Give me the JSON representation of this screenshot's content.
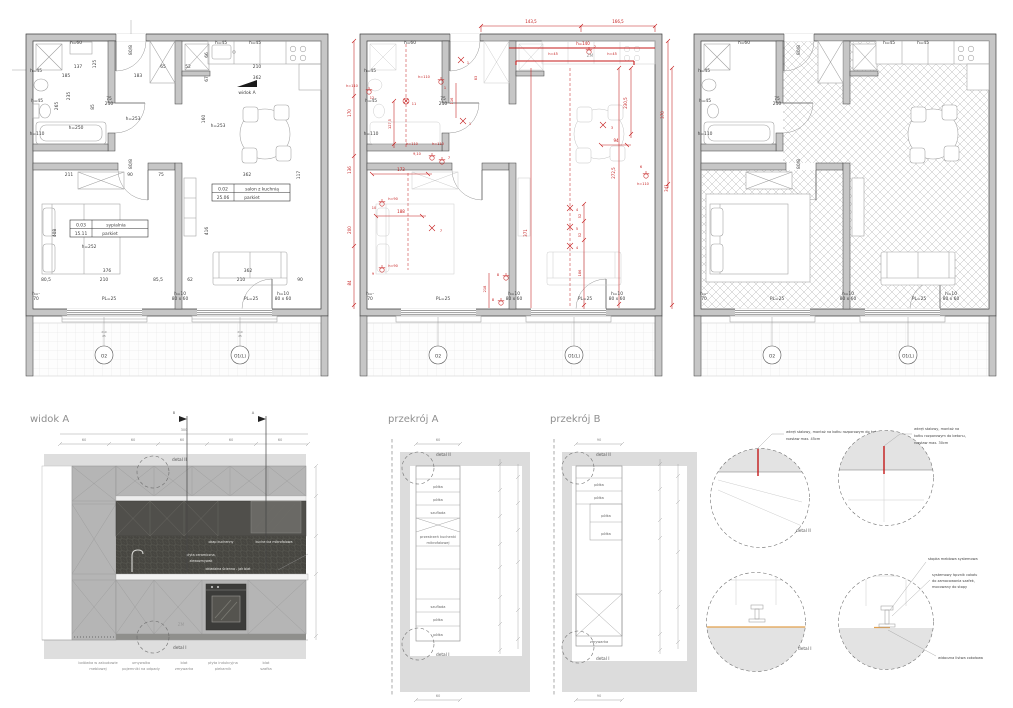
{
  "colors": {
    "red": "#c41a1a",
    "orange": "#e2a14e",
    "wall_gray": "#c6c6c6",
    "dark_tile": "#474641"
  },
  "plan1": {
    "labels": [
      "h=60",
      "137",
      "185",
      "125",
      "80/8",
      "183",
      "65",
      "52",
      "66",
      "h=45",
      "h=45",
      "210",
      "67",
      "362",
      "widok A",
      "h=45",
      "235",
      "265",
      "h=45",
      "75",
      "210",
      "85",
      "h=253",
      "160",
      "h=253",
      "h=250",
      "h=110",
      "362",
      "117",
      "211",
      "90",
      "75",
      "80/8",
      "408",
      "h=252",
      "416",
      "376",
      "80,5",
      "210",
      "85,5",
      "62",
      "210",
      "90",
      "362",
      "h=-",
      "70",
      "PL=25",
      "PL=25",
      "h=10",
      "80 x 60",
      "h=10",
      "80 x 60",
      "O2",
      "O1(L)",
      "210",
      "25",
      "210",
      "25"
    ],
    "salon": {
      "no": "0.02",
      "name": "salon z kuchnią",
      "area": "25.06",
      "floor": "parkiet"
    },
    "sypialnia": {
      "no": "0.03",
      "name": "sypialnia",
      "area": "15.11",
      "floor": "parkiet"
    }
  },
  "plan2": {
    "black_labels": [
      "h=60",
      "h=45",
      "h=45",
      "h=110",
      "75",
      "210",
      "h=10",
      "80 x 60",
      "h=10",
      "80 x 60",
      "PL=25",
      "PL=25",
      "h=-",
      "70",
      "O2",
      "O1(L)",
      "ZM"
    ],
    "red_labels": [
      "143,5",
      "166,5",
      "h=140",
      "h=45",
      "2",
      "h=45",
      "230,5",
      "370",
      "94",
      "341",
      "272,5",
      "6",
      "h=110",
      "3",
      "4",
      "5",
      "4",
      "52",
      "52",
      "186",
      "371",
      "h=110",
      "12",
      "11",
      "127,5",
      "h=110",
      "1",
      "1",
      "1",
      "116",
      "83",
      "h=110",
      "h=110",
      "9,10",
      "7",
      "170",
      "136",
      "200",
      "84",
      "173",
      "10",
      "h=90",
      "188",
      "7",
      "9",
      "h=90",
      "8",
      "8",
      "218"
    ]
  },
  "plan3": {
    "labels": [
      "h=60",
      "h=45",
      "h=45",
      "h=110",
      "75",
      "210",
      "h=45",
      "h=45",
      "h=10",
      "80 x 60",
      "h=10",
      "80 x 60",
      "PL=25",
      "PL=25",
      "h=-",
      "70",
      "O2",
      "O1(L)",
      "80/8",
      "80/8"
    ]
  },
  "widok": {
    "title": "widok A",
    "dims": [
      "60",
      "60",
      "60",
      "60",
      "60"
    ],
    "total": "300",
    "sec_b": "B",
    "sec_a": "A",
    "detal_ii": "detal II",
    "detal_i": "detal I",
    "hood": "okap kuchenny",
    "micro": "kuchenka mikrofalowa",
    "sp1": "płyta ceramiczna,",
    "sp2": "zlewozmywak",
    "sp3": "okładzina ścienna - jak blat",
    "zm": "ZM",
    "legend": [
      [
        "lodówka w zabudowie",
        "meblowej"
      ],
      [
        "umywalka",
        "pojemniki na odpady"
      ],
      [
        "blat",
        "zmywarka"
      ],
      [
        "płyta indukcyjna",
        "piekarnik"
      ],
      [
        "blat",
        "szafka"
      ]
    ]
  },
  "przekrojA": {
    "title": "przekrój A",
    "cells": [
      "półka",
      "półka",
      "szuflada",
      "przestrzeń kuchenki",
      "mikrofalowej",
      "szuflada",
      "półka",
      "półka"
    ],
    "detal_ii": "detal II",
    "detal_i": "detal I",
    "dim_top": "60",
    "dim_bottom": "60"
  },
  "przekrojB": {
    "title": "przekrój B",
    "cells": [
      "półka",
      "półka",
      "półka",
      "półka"
    ],
    "zmywarka": "zmywarka",
    "detal_ii": "detal II",
    "detal_i": "detal I",
    "dim_top": "90",
    "dim_bottom": "90"
  },
  "detale": {
    "d2": "detal II",
    "d1": "detal I",
    "n45a": "wkręt stalowy, montaż na kołku rozporowym do betonu,",
    "n45b": "rozstaw max. 45cm",
    "n30a": "wkręt stalowy, montaż na",
    "n30b": "kołku rozporowym do betonu,",
    "n30c": "rozstaw max. 30cm",
    "s1": "stopka meblowa systemowa",
    "s2a": "systemowy łącznik cokołu",
    "s2b": "do zamocowania szafek,",
    "s2c": "mocowany do stopy",
    "s3": "widoczna listwa cokołowa"
  }
}
